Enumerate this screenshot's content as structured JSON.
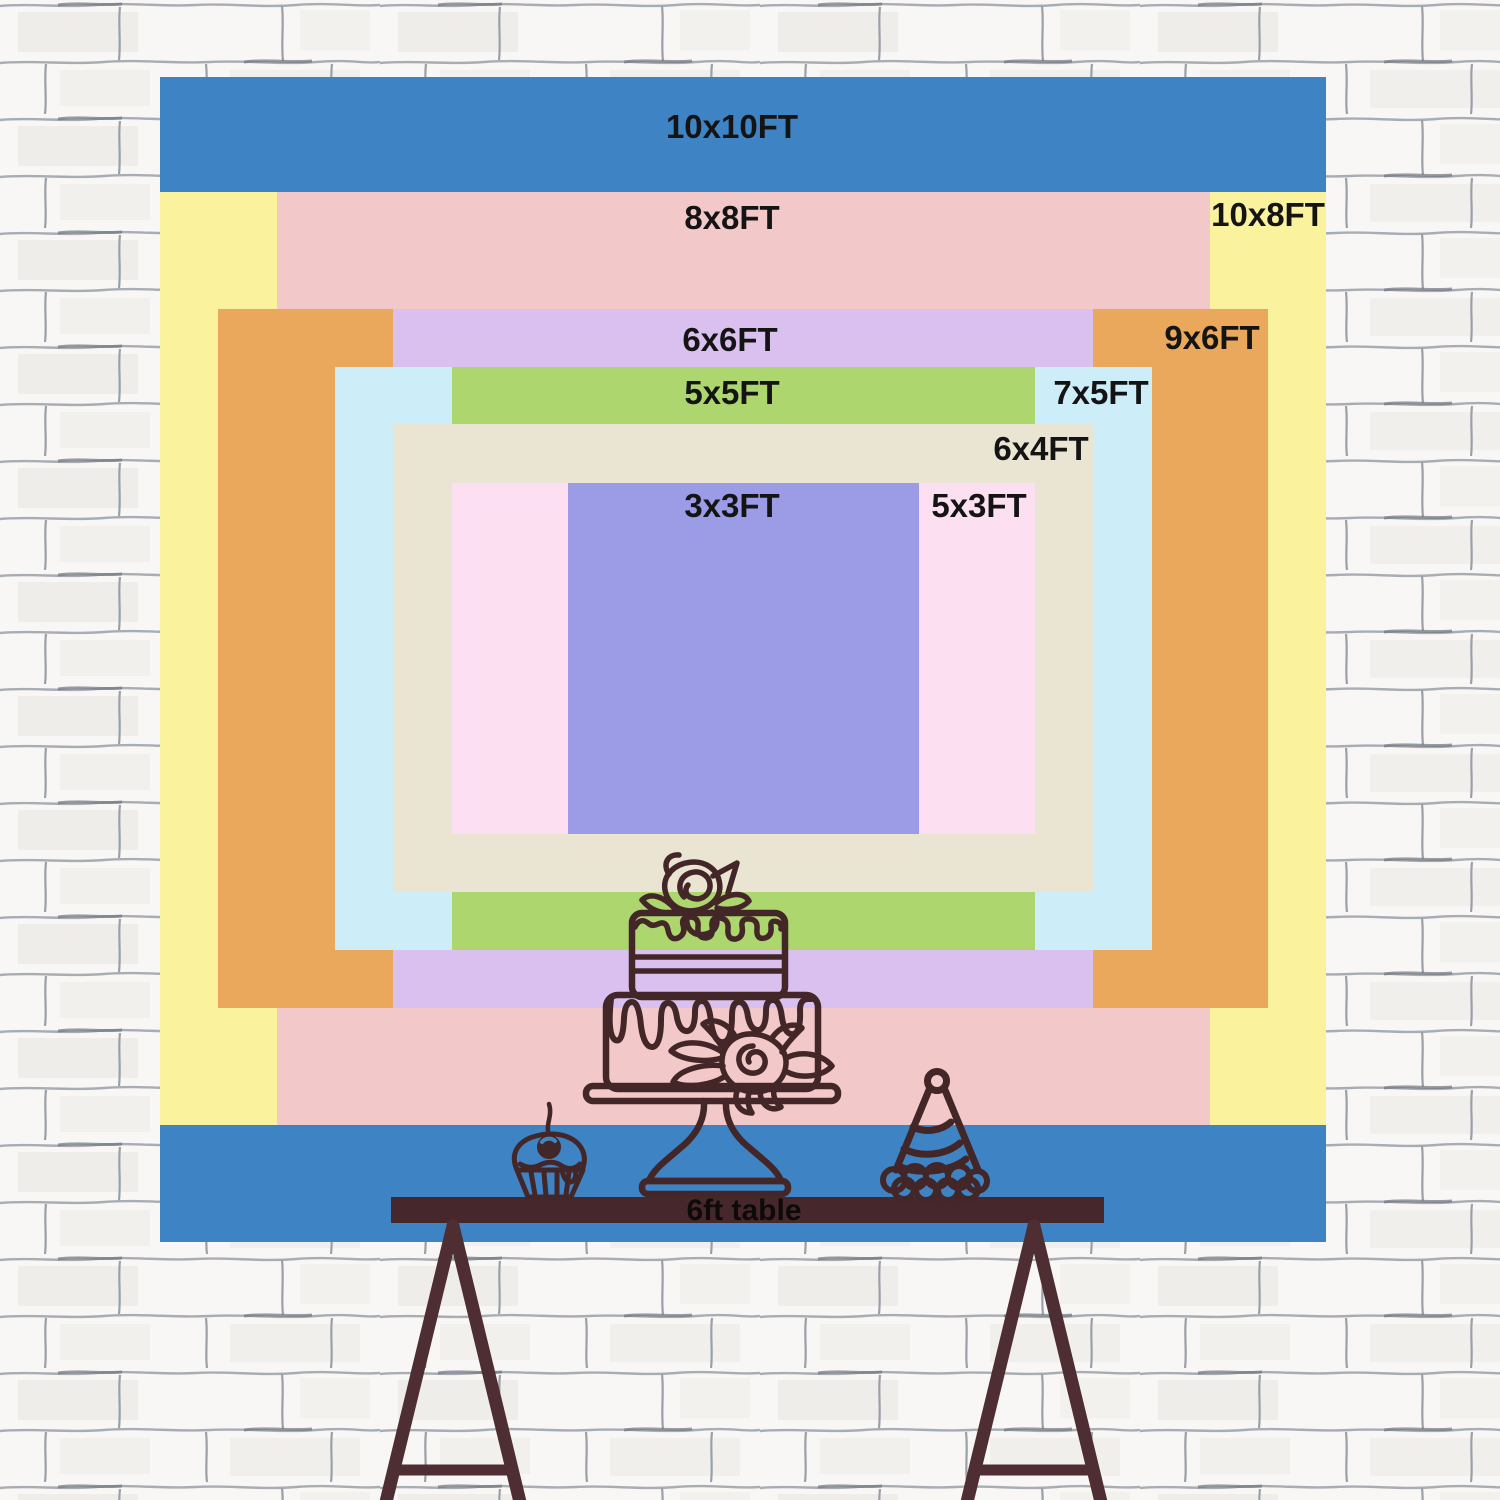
{
  "title": "Backdrop size comparison chart",
  "backdrop": {
    "unit": "FT",
    "layers": [
      {
        "label": "10x10FT",
        "size": "10x10",
        "width_ft": 10,
        "height_ft": 10,
        "color": "#3e84c4"
      },
      {
        "label": "10x8FT",
        "size": "10x8",
        "width_ft": 10,
        "height_ft": 8,
        "color": "#faf29c"
      },
      {
        "label": "8x8FT",
        "size": "8x8",
        "width_ft": 8,
        "height_ft": 8,
        "color": "#f3c8c8"
      },
      {
        "label": "9x6FT",
        "size": "9x6",
        "width_ft": 9,
        "height_ft": 6,
        "color": "#e9a85c"
      },
      {
        "label": "6x6FT",
        "size": "6x6",
        "width_ft": 6,
        "height_ft": 6,
        "color": "#d9c0ee"
      },
      {
        "label": "7x5FT",
        "size": "7x5",
        "width_ft": 7,
        "height_ft": 5,
        "color": "#cdedf8"
      },
      {
        "label": "5x5FT",
        "size": "5x5",
        "width_ft": 5,
        "height_ft": 5,
        "color": "#aed66e"
      },
      {
        "label": "6x4FT",
        "size": "6x4",
        "width_ft": 6,
        "height_ft": 4,
        "color": "#eae5d3"
      },
      {
        "label": "5x3FT",
        "size": "5x3",
        "width_ft": 5,
        "height_ft": 3,
        "color": "#fce0f1"
      },
      {
        "label": "3x3FT",
        "size": "3x3",
        "width_ft": 3,
        "height_ft": 3,
        "color": "#9b9ce5"
      }
    ]
  },
  "table": {
    "label": "6ft table",
    "bar_color": "#46282c",
    "leg_color": "#4f2e33"
  },
  "artwork": {
    "ink_color": "#432628",
    "items": [
      "birthday-cake",
      "cupcake-with-cherry",
      "party-hat"
    ]
  },
  "wall": {
    "style": "white painted brick",
    "mortar_line_color": "#a8adb4"
  }
}
